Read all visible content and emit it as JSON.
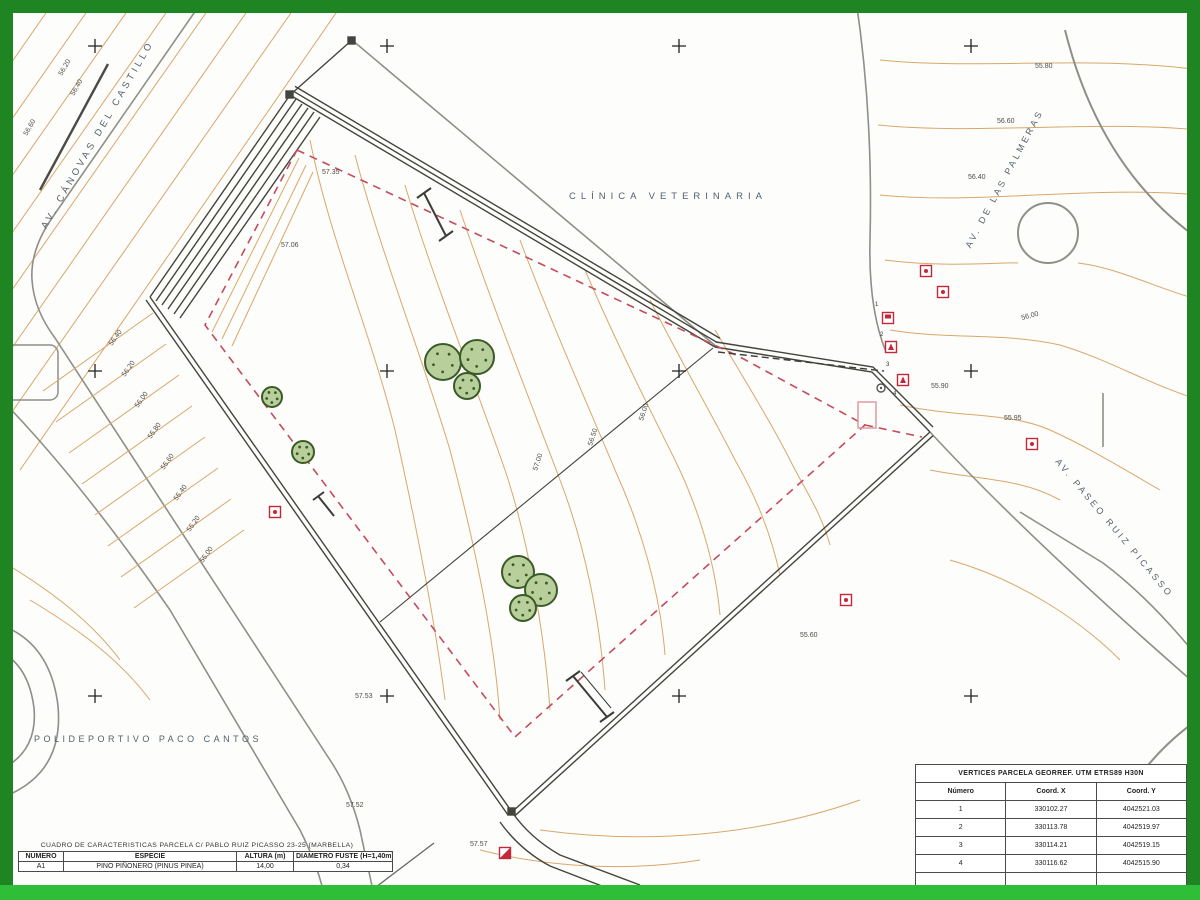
{
  "map": {
    "street_labels": [
      {
        "text": "AV. CÁNOVAS DEL CASTILLO",
        "x": 100,
        "y": 136,
        "rot": -60,
        "ls": 3.5,
        "fs": 9.5
      },
      {
        "text": "CLÍNICA VETERINARIA",
        "x": 668,
        "y": 199,
        "rot": 0,
        "ls": 5,
        "fs": 9.5
      },
      {
        "text": "AV. DE LAS PALMERAS",
        "x": 1007,
        "y": 180,
        "rot": -62,
        "ls": 3,
        "fs": 9
      },
      {
        "text": "AV. PASEO RUIZ PICASSO",
        "x": 1112,
        "y": 530,
        "rot": 50,
        "ls": 3,
        "fs": 9
      },
      {
        "text": "POLIDEPORTIVO PACO CANTOS",
        "x": 148,
        "y": 742,
        "rot": 0,
        "ls": 3.5,
        "fs": 9
      }
    ],
    "spot_elevations": [
      {
        "text": "57.35",
        "x": 322,
        "y": 174,
        "rot": 0
      },
      {
        "text": "57.06",
        "x": 281,
        "y": 247,
        "rot": 0
      },
      {
        "text": "55.90",
        "x": 931,
        "y": 388,
        "rot": 0
      },
      {
        "text": "55.95",
        "x": 1004,
        "y": 420,
        "rot": 0
      },
      {
        "text": "57.53",
        "x": 355,
        "y": 698,
        "rot": 0
      },
      {
        "text": "57.52",
        "x": 346,
        "y": 807,
        "rot": 0
      },
      {
        "text": "57.57",
        "x": 470,
        "y": 846,
        "rot": 0
      },
      {
        "text": "55.80",
        "x": 1035,
        "y": 68,
        "rot": 0
      },
      {
        "text": "56.60",
        "x": 997,
        "y": 123,
        "rot": 0
      },
      {
        "text": "56.40",
        "x": 968,
        "y": 179,
        "rot": 0
      },
      {
        "text": "55.60",
        "x": 800,
        "y": 637,
        "rot": 0
      },
      {
        "text": "56.20",
        "x": 62,
        "y": 76,
        "rot": -60
      },
      {
        "text": "56.60",
        "x": 27,
        "y": 136,
        "rot": -60
      },
      {
        "text": "56.40",
        "x": 74,
        "y": 96,
        "rot": -60
      },
      {
        "text": "56.00",
        "x": 1022,
        "y": 320,
        "rot": -15
      },
      {
        "text": "56.00",
        "x": 643,
        "y": 421,
        "rot": -72
      },
      {
        "text": "56.50",
        "x": 592,
        "y": 446,
        "rot": -72
      },
      {
        "text": "57.00",
        "x": 537,
        "y": 471,
        "rot": -72
      }
    ],
    "stair_marks": [
      {
        "x": 98,
        "y": 352,
        "label": "56.40"
      },
      {
        "x": 111,
        "y": 383,
        "label": "56.20"
      },
      {
        "x": 124,
        "y": 414,
        "label": "56.00"
      },
      {
        "x": 137,
        "y": 445,
        "label": "55.80"
      },
      {
        "x": 150,
        "y": 476,
        "label": "55.60"
      },
      {
        "x": 163,
        "y": 507,
        "label": "55.40"
      },
      {
        "x": 176,
        "y": 538,
        "label": "55.20"
      },
      {
        "x": 189,
        "y": 569,
        "label": "55.00"
      }
    ],
    "grid_crosses": {
      "xs": [
        95,
        387,
        679,
        971
      ],
      "ys": [
        46,
        371,
        696
      ]
    },
    "trees": [
      {
        "x": 443,
        "y": 362,
        "r": 18
      },
      {
        "x": 477,
        "y": 357,
        "r": 17
      },
      {
        "x": 467,
        "y": 386,
        "r": 13
      },
      {
        "x": 272,
        "y": 397,
        "r": 10
      },
      {
        "x": 303,
        "y": 452,
        "r": 11
      },
      {
        "x": 518,
        "y": 572,
        "r": 16
      },
      {
        "x": 541,
        "y": 590,
        "r": 16
      },
      {
        "x": 523,
        "y": 608,
        "r": 13
      }
    ],
    "symbols": [
      {
        "x": 926,
        "y": 271,
        "g": "dot"
      },
      {
        "x": 943,
        "y": 292,
        "g": "dot"
      },
      {
        "x": 888,
        "y": 318,
        "g": "flag"
      },
      {
        "x": 891,
        "y": 347,
        "g": "tri"
      },
      {
        "x": 903,
        "y": 380,
        "g": "tri"
      },
      {
        "x": 1032,
        "y": 444,
        "g": "dot"
      },
      {
        "x": 846,
        "y": 600,
        "g": "dot"
      },
      {
        "x": 275,
        "y": 512,
        "g": "dot"
      },
      {
        "x": 505,
        "y": 853,
        "g": "slash"
      }
    ],
    "vertex_numbers": [
      {
        "t": "1",
        "x": 875,
        "y": 306
      },
      {
        "t": "2",
        "x": 880,
        "y": 336
      },
      {
        "t": "3",
        "x": 886,
        "y": 366
      },
      {
        "t": "4",
        "x": 893,
        "y": 395
      }
    ]
  },
  "tables": {
    "caracteristicas": {
      "title": "CUADRO DE CARACTERISTICAS  PARCELA C/ PABLO RUIZ PICASSO 23-25 (MARBELLA)",
      "headers": [
        "NÚMERO",
        "ESPECIE",
        "ALTURA (m)",
        "DIAMETRO FUSTE (H=1,40m)"
      ],
      "rows": [
        [
          "A1",
          "PINO PIÑONERO (PINUS PINEA)",
          "14,00",
          "0,34"
        ]
      ]
    },
    "vertices": {
      "title": "VERTICES PARCELA GEORREF. UTM ETRS89 H30N",
      "headers": [
        "Número",
        "Coord. X",
        "Coord. Y"
      ],
      "rows": [
        [
          "1",
          "330102.27",
          "4042521.03"
        ],
        [
          "2",
          "330113.78",
          "4042519.97"
        ],
        [
          "3",
          "330114.21",
          "4042519.15"
        ],
        [
          "4",
          "330116.62",
          "4042515.90"
        ]
      ]
    }
  },
  "colors": {
    "frame_green": "#1f8523",
    "bottom_strip_green": "#2fbe37",
    "contour_orange": "#d9a76b",
    "boundary_red": "#c54b5d",
    "road_gray": "#8f8f88",
    "wall_gray": "#44443f",
    "tree_fill": "#b9cf9b",
    "tree_stroke": "#3a5a28",
    "symbol_red": "#c2273a"
  }
}
